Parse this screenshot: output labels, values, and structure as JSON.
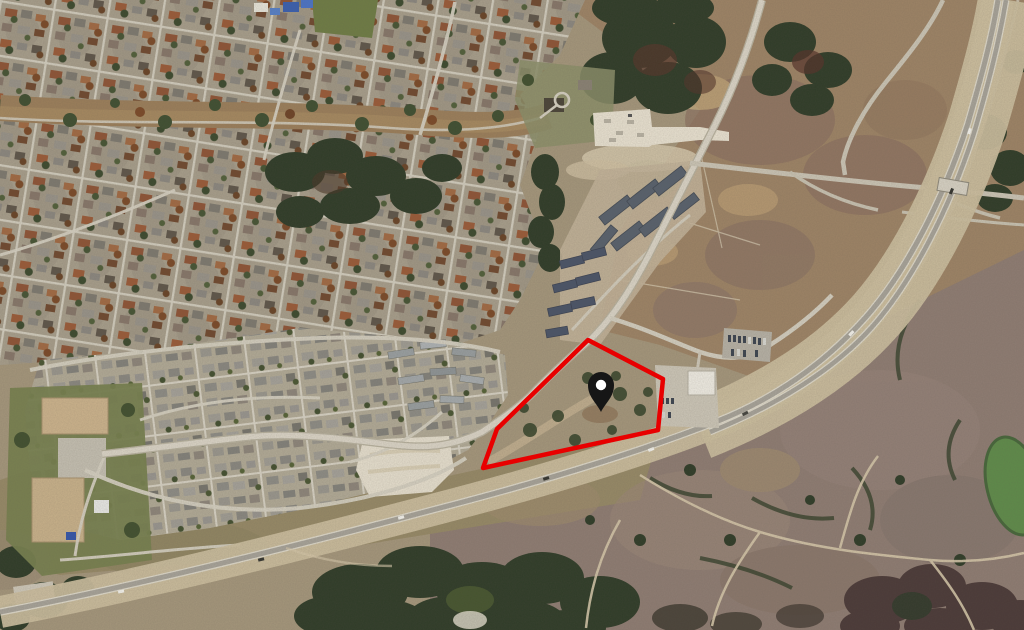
{
  "map": {
    "view_mode": "satellite-aerial",
    "description": "Aerial satellite photo of a suburban area: dense residential neighborhoods to the north-west, a greenbelt creek corridor, an apartment complex and cleared commercial pads near the center, a divided highway sweeping from the top-right corner to the bottom-left edge, open pasture to the east and mauve brushland to the south-east. A vacant land parcel is outlined in red with a black location pin at its center.",
    "marker": {
      "x": 601,
      "y": 388,
      "transform": "translate(601,388)",
      "color": "#161616",
      "inner_color": "#ffffff"
    },
    "parcel": {
      "points_attr": "588,340 663,379 658,430 483,468 497,429",
      "points": [
        [
          588,
          340
        ],
        [
          663,
          379
        ],
        [
          658,
          430
        ],
        [
          483,
          468
        ],
        [
          497,
          429
        ]
      ],
      "stroke_color": "#e80000",
      "stroke_width_px": 4.5,
      "fill": "none"
    },
    "palette": {
      "base_tan": "#a5977c",
      "suburb_base": "#a89f8c",
      "suburb_south": "#b2ab97",
      "road_light": "#d9d3c4",
      "pavement_gray": "#a8a49a",
      "highway_corridor_sand": "#ccbf9f",
      "forest_dark": "#2f3c28",
      "greenbelt_tan": "#9c7f5b",
      "field_east": "#9e8466",
      "scrub_mauve": "#8f7d73",
      "pad_white": "#eae3d2",
      "apartment_roof": "#58616d",
      "pond_green": "#5f8c4a",
      "parcel_red": "#e80000",
      "pin_black": "#161616"
    },
    "features": [
      "dense-residential-neighborhood-northwest",
      "suburban-subdivision-south",
      "greenbelt-creek-corridor",
      "forest-patches",
      "hilltop-estate-lots",
      "apartment-complex",
      "white-staging-pad",
      "school-campus",
      "cleared-sand-pad",
      "commercial-parcel-with-parking",
      "roadside-parking-lot",
      "arterial-road",
      "frontage-roads",
      "divided-highway-southeast",
      "overpass-interchange-northeast",
      "open-pasture-fields-east",
      "brushland-scrub-southeast",
      "dirt-trails",
      "green-pond",
      "red-parcel-outline",
      "black-location-pin"
    ]
  }
}
